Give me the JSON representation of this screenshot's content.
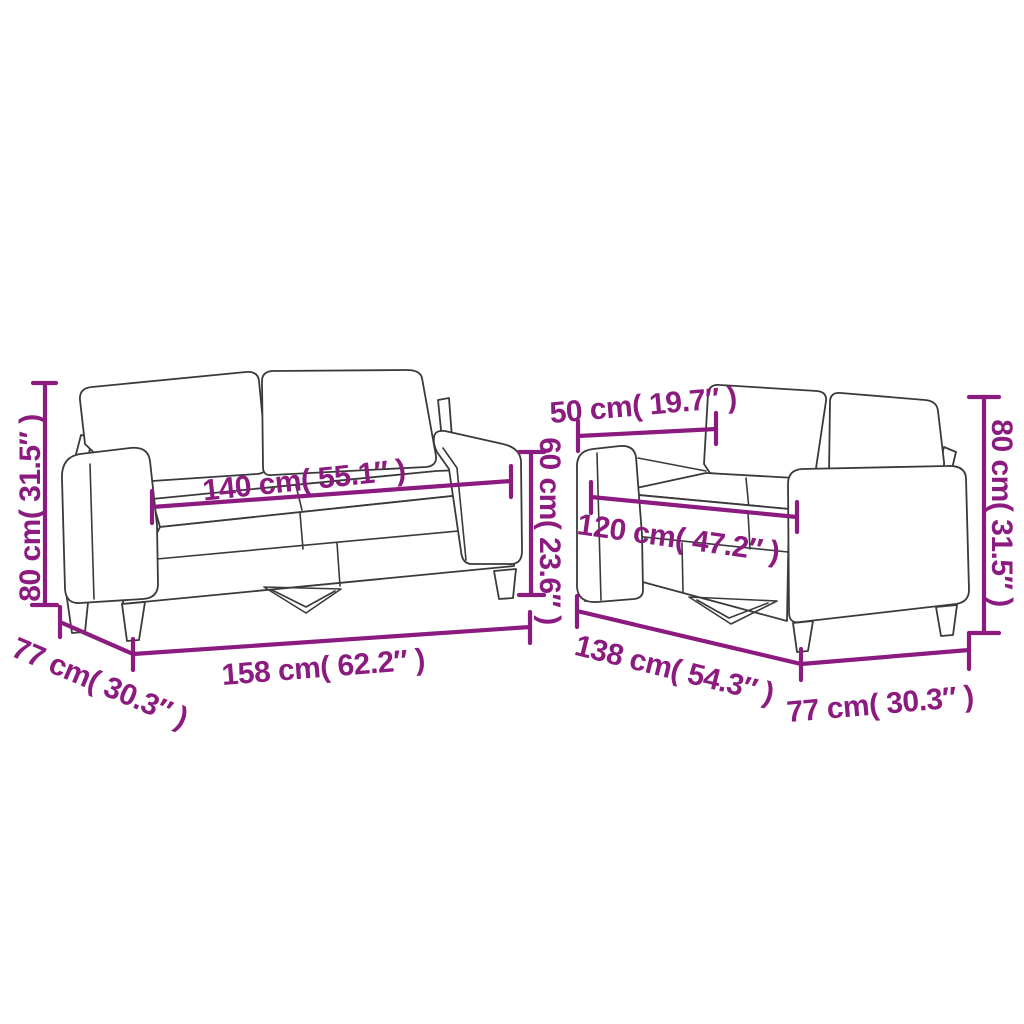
{
  "style": {
    "background": "#ffffff",
    "dimension_color": "#8c1b80",
    "drawing_color": "#3a3a3a"
  },
  "diagram": {
    "kind": "sofa-set-dimension-diagram",
    "sofa_a": {
      "height_label": "80 cm( 31.5″ )",
      "seat_width_label": "140 cm( 55.1″ )",
      "seat_back_height_label": "60 cm( 23.6″ )",
      "depth_label": "77 cm( 30.3″ )",
      "overall_width_label": "158 cm( 62.2″ )"
    },
    "sofa_b": {
      "arm_depth_label": "50 cm( 19.7″ )",
      "seat_width_label": "120 cm( 47.2″ )",
      "overall_width_label": "138 cm( 54.3″ )",
      "depth_label": "77 cm( 30.3″ )",
      "height_label": "80 cm( 31.5″ )"
    }
  }
}
